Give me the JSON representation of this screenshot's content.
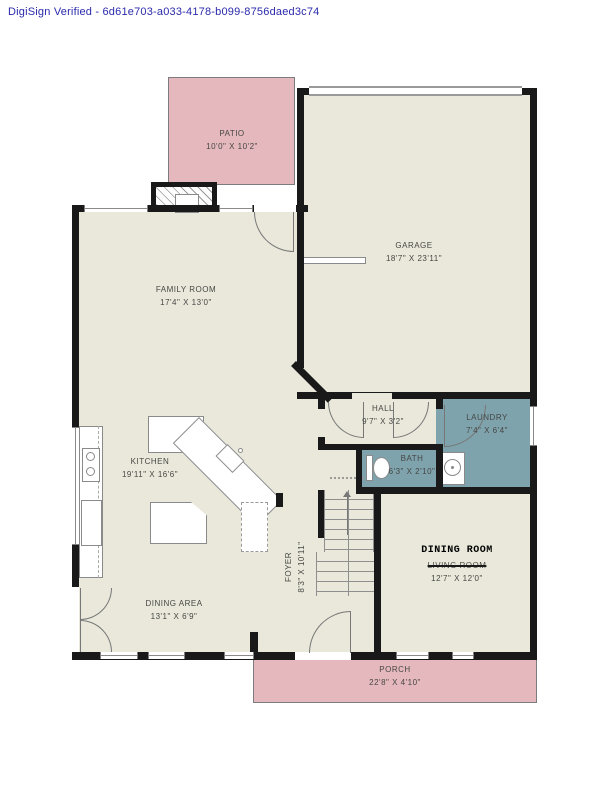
{
  "document": {
    "verification_text": "DigiSign Verified - 6d61e703-a033-4178-b099-8756daed3c74"
  },
  "colors": {
    "header_text": "#2a2aad",
    "wall": "#191919",
    "floor": "#e9e8db",
    "outdoor_area": "#e4b8bc",
    "wet_room": "#7ea3ad",
    "label_text": "#474744",
    "annotation_text": "#000000"
  },
  "rooms": {
    "patio": {
      "name": "PATIO",
      "dims": "10'0\" X 10'2\""
    },
    "garage": {
      "name": "GARAGE",
      "dims": "18'7\" X 23'11\""
    },
    "family_room": {
      "name": "FAMILY ROOM",
      "dims": "17'4\" X 13'0\""
    },
    "kitchen": {
      "name": "KITCHEN",
      "dims": "19'11\" X 16'6\""
    },
    "dining_area": {
      "name": "DINING AREA",
      "dims": "13'1\" X 6'9\""
    },
    "hall": {
      "name": "HALL",
      "dims": "9'7\" X 3'2\""
    },
    "laundry": {
      "name": "LAUNDRY",
      "dims": "7'4\" X 6'4\""
    },
    "bath": {
      "name": "BATH",
      "dims": "6'3\" X 2'10\""
    },
    "foyer": {
      "name": "FOYER",
      "dims": "8'3\" X 10'11\""
    },
    "dining_room": {
      "annotated_name": "DINING ROOM",
      "original_name": "LIVING ROOM",
      "dims": "12'7\" X 12'0\""
    },
    "porch": {
      "name": "PORCH",
      "dims": "22'8\" X 4'10\""
    }
  }
}
